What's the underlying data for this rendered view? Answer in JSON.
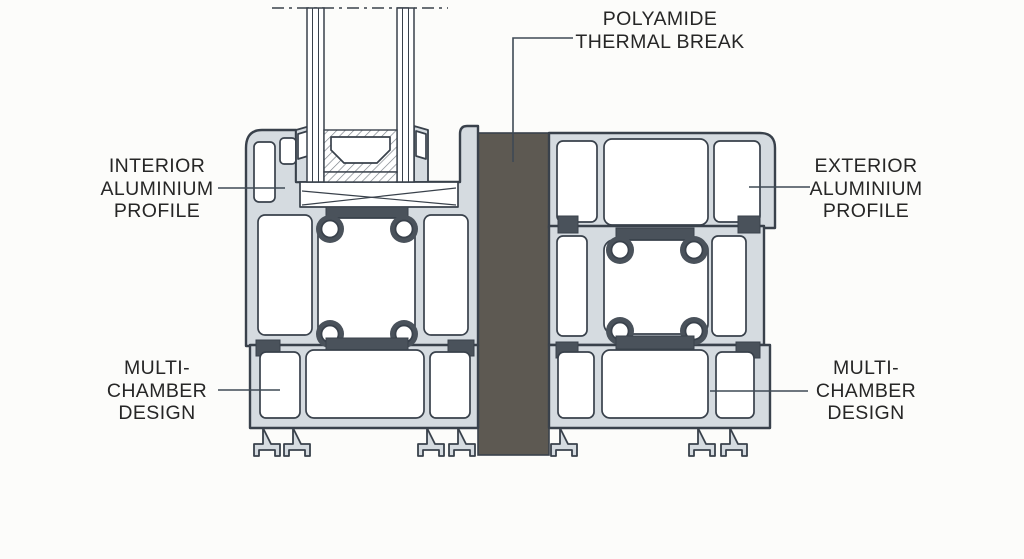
{
  "diagram": {
    "description": "Cross-section of a thermally broken aluminium window profile with insulated glazing",
    "colors": {
      "background": "#fcfcfa",
      "aluminium": "#d5dbe0",
      "outline": "#39414b",
      "chamber": "#ffffff",
      "thermal_break": "#5d5952",
      "gasket": "#4a525b",
      "hatch": "#7a8088",
      "leader": "#3f4a55",
      "text": "#262626"
    },
    "labels": {
      "polyamide": {
        "lines": [
          "POLYAMIDE",
          "THERMAL BREAK"
        ]
      },
      "interior": {
        "lines": [
          "INTERIOR",
          "ALUMINIUM",
          "PROFILE"
        ]
      },
      "exterior": {
        "lines": [
          "EXTERIOR",
          "ALUMINIUM",
          "PROFILE"
        ]
      },
      "multi_chamber_left": {
        "lines": [
          "MULTI-",
          "CHAMBER",
          "DESIGN"
        ]
      },
      "multi_chamber_right": {
        "lines": [
          "MULTI-",
          "CHAMBER",
          "DESIGN"
        ]
      }
    }
  }
}
